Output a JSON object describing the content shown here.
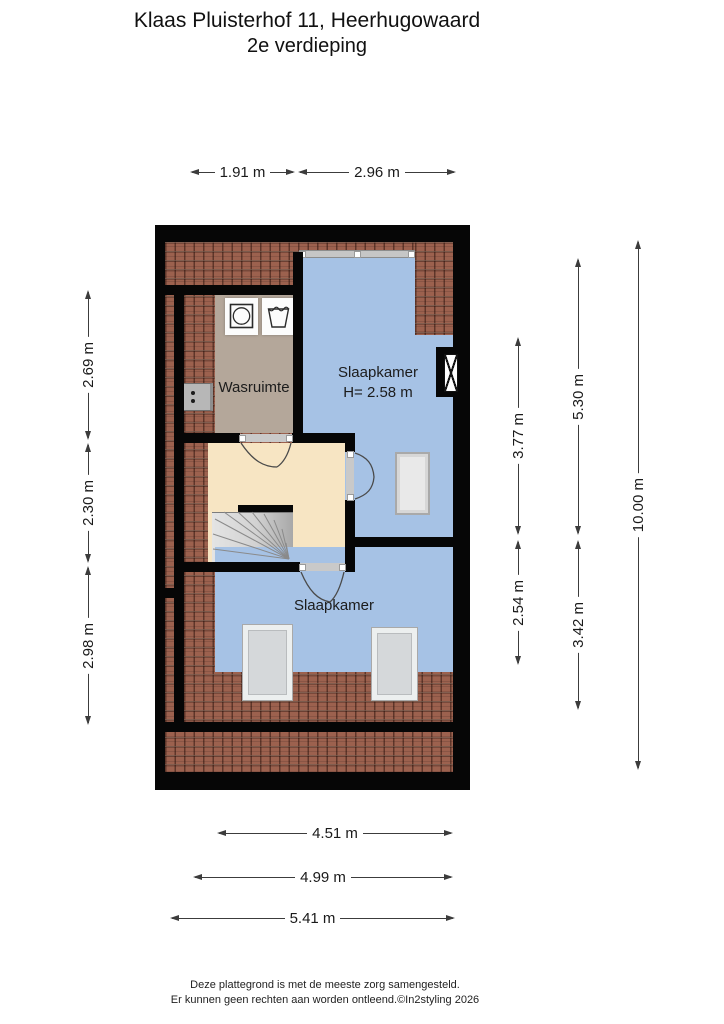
{
  "title": {
    "line1": "Klaas Pluisterhof 11, Heerhugowaard",
    "line2": "2e verdieping"
  },
  "rooms": {
    "slaapkamer_top": {
      "label": "Slaapkamer",
      "height_note": "H= 2.58 m"
    },
    "wasruimte": {
      "label": "Wasruimte"
    },
    "slaapkamer_bottom": {
      "label": "Slaapkamer"
    }
  },
  "dimensions": {
    "top": [
      {
        "label": "1.91 m"
      },
      {
        "label": "2.96 m"
      }
    ],
    "left": [
      {
        "label": "2.69 m"
      },
      {
        "label": "2.30 m"
      },
      {
        "label": "2.98 m"
      }
    ],
    "right_inner": [
      {
        "label": "3.77 m"
      },
      {
        "label": "2.54 m"
      }
    ],
    "right_middle": [
      {
        "label": "5.30 m"
      },
      {
        "label": "3.42 m"
      }
    ],
    "right_outer": [
      {
        "label": "10.00 m"
      }
    ],
    "bottom": [
      {
        "label": "4.51 m"
      },
      {
        "label": "4.99 m"
      },
      {
        "label": "5.41 m"
      }
    ]
  },
  "footer": {
    "line1": "Deze plattegrond is met de meeste zorg samengesteld.",
    "line2": "Er kunnen geen rechten aan worden ontleend.©In2styling 2026"
  },
  "icons": {
    "washing_machine": "washing-machine-icon",
    "laundry_sink": "laundry-sink-icon",
    "chimney": "chimney-flue-icon",
    "meter_cabinet": "meter-cabinet-icon"
  },
  "colors": {
    "room_blue": "#a6c2e5",
    "laundry_taupe": "#b4a79a",
    "hall_cream": "#f7e5c3",
    "roof_tile": "#9c614e",
    "wall_black": "#060606"
  }
}
